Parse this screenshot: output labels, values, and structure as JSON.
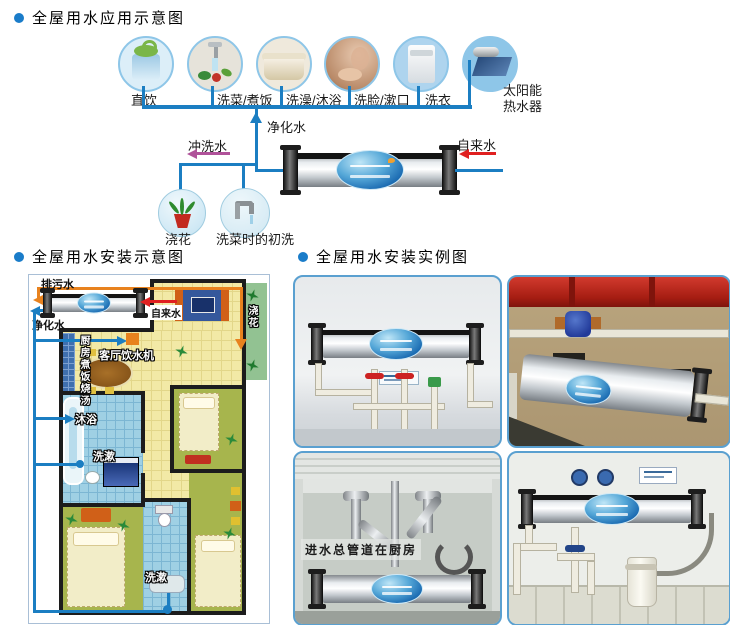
{
  "sections": {
    "application": {
      "title": "全屋用水应用示意图"
    },
    "installation": {
      "title": "全屋用水安装示意图"
    },
    "examples": {
      "title": "全屋用水安装实例图"
    }
  },
  "application_diagram": {
    "uses": [
      {
        "label": "直饮",
        "icon": "drinking-dispenser-icon"
      },
      {
        "label": "洗菜/煮饭",
        "icon": "vegetable-washing-icon"
      },
      {
        "label": "洗澡/沐浴",
        "icon": "bathtub-icon"
      },
      {
        "label": "洗脸/漱口",
        "icon": "face-washing-icon"
      },
      {
        "label": "洗衣",
        "icon": "washing-machine-icon"
      },
      {
        "label": "太阳能热水器",
        "icon": "solar-water-heater-icon"
      }
    ],
    "pipes": {
      "purified": "净化水",
      "flush": "冲洗水",
      "tap": "自来水"
    },
    "flush_points": [
      {
        "label": "浇花",
        "icon": "flower-pot-icon"
      },
      {
        "label": "洗菜时的初洗",
        "icon": "faucet-icon"
      }
    ]
  },
  "floor_plan": {
    "waste_label": "排污水",
    "tap_label": "自来水",
    "purified_label": "净化水",
    "kitchen_label": "厨房煮饭烧汤",
    "dispenser_label": "客厅饮水机",
    "bath_label": "沐浴",
    "wash_label_1": "洗漱",
    "wash_label_2": "洗漱",
    "balcony_label": "浇花"
  },
  "photos": {
    "under_sink_caption": "进水总管道在厨房"
  },
  "colors": {
    "pipe_blue": "#1b7ec2",
    "waste_orange": "#e8821e",
    "tap_red": "#e02020",
    "flush_purple": "#b0529a",
    "photo_border": "#5aa0d0",
    "bullet_blue": "#1a7cc9"
  }
}
